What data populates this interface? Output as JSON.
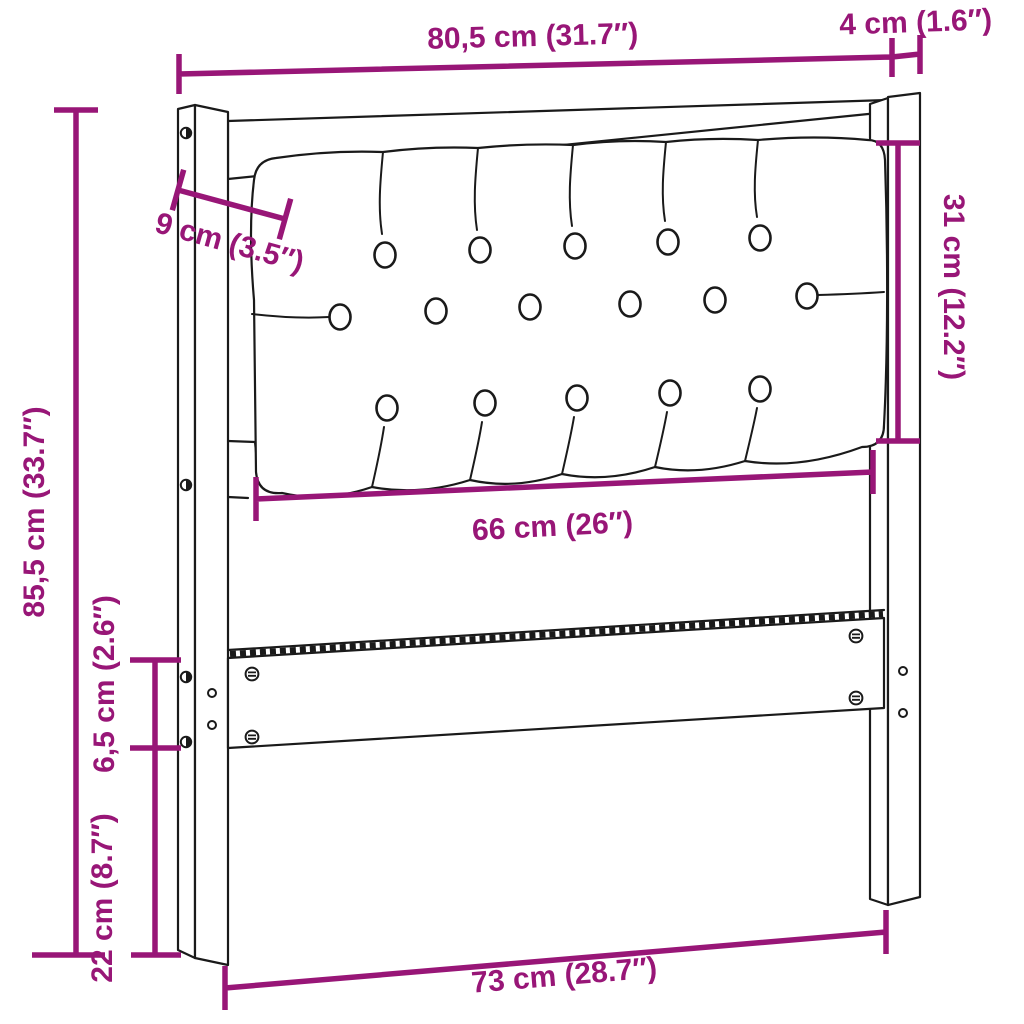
{
  "diagram": {
    "title": "headboard-dimension-diagram",
    "colors": {
      "accent": "#981677",
      "line": "#1a1a1a",
      "background": "#ffffff"
    },
    "dimensions": {
      "overall_width": "80,5 cm (31.7″)",
      "post_depth": "4 cm (1.6″)",
      "overall_height": "85,5 cm (33.7″)",
      "panel_height": "31 cm (12.2″)",
      "panel_side_inset": "9 cm (3.5″)",
      "panel_width": "66 cm (26″)",
      "rail_height": "6,5 cm (2.6″)",
      "leg_clearance": "22 cm (8.7″)",
      "inner_width": "73 cm (28.7″)"
    }
  }
}
